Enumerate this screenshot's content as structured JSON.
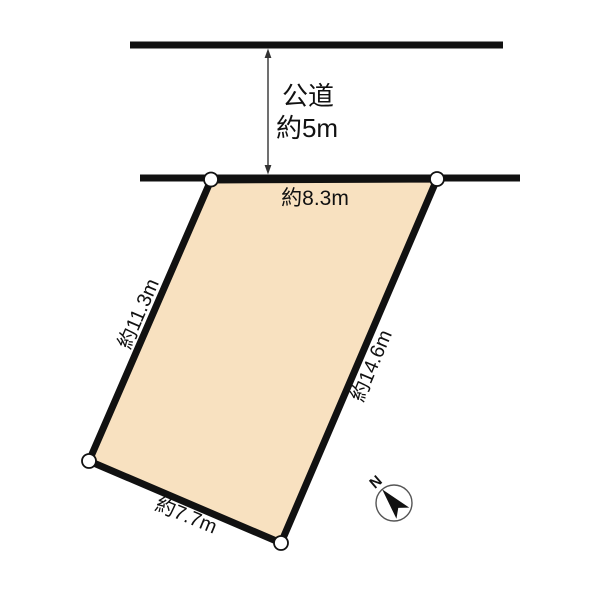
{
  "diagram": {
    "background_color": "#ffffff",
    "line_color": "#111111",
    "text_color": "#111111"
  },
  "road": {
    "name_label": "公道",
    "width_label": "約5m"
  },
  "parcel": {
    "fill_color": "#F8E1C0",
    "edge_labels": {
      "top": "約8.3m",
      "left": "約11.3m",
      "right": "約14.6m",
      "bottom": "約7.7m"
    }
  },
  "compass": {
    "north_label": "N"
  }
}
